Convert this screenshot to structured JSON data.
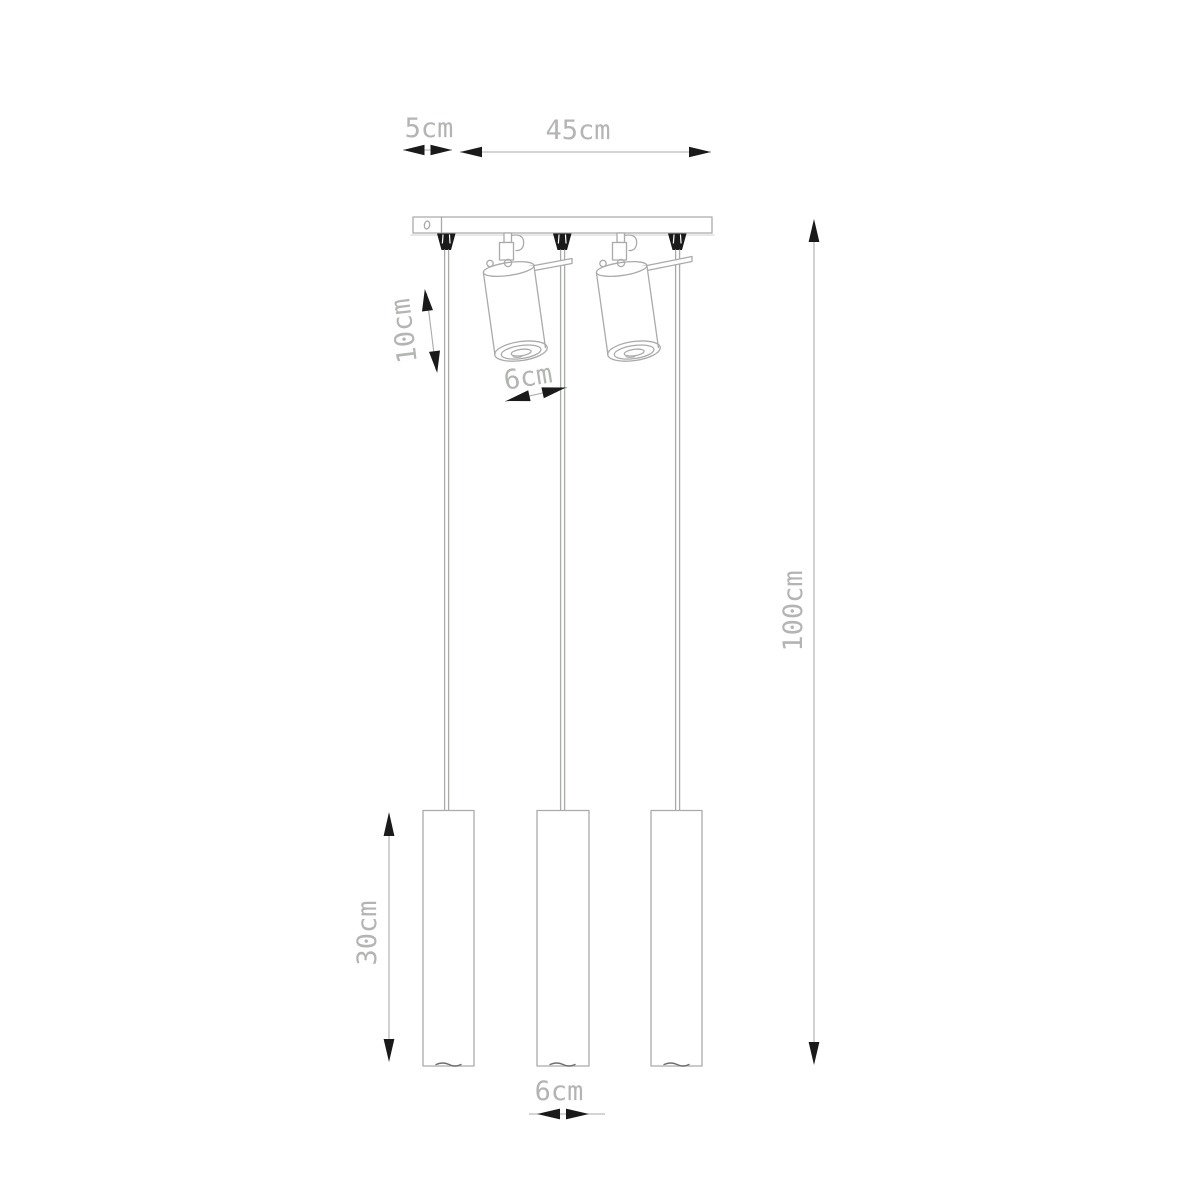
{
  "dimensions": {
    "canopy_side": {
      "label": "5cm"
    },
    "canopy_width": {
      "label": "45cm"
    },
    "spot_length": {
      "label": "10cm"
    },
    "spot_diameter": {
      "label": "6cm"
    },
    "overall_height": {
      "label": "100cm"
    },
    "tube_length": {
      "label": "30cm"
    },
    "tube_diameter": {
      "label": "6cm"
    }
  },
  "colors": {
    "line": "#a9aba9",
    "dimension_text": "#b2b5b2",
    "arrow": "#1a1a1a",
    "background": "#ffffff"
  }
}
